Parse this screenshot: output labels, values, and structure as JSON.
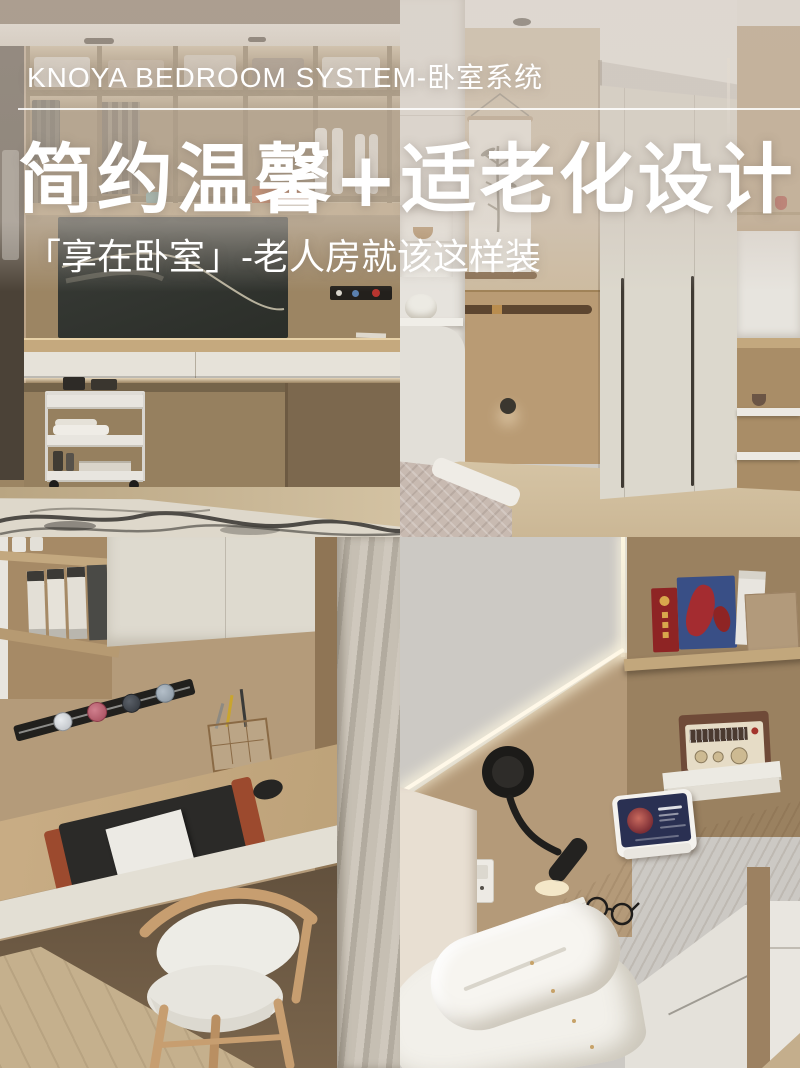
{
  "canvas": {
    "width": 800,
    "height": 1068
  },
  "overlay": {
    "brand_line": "KNOYA BEDROOM SYSTEM-卧室系统",
    "title": "简约温馨+适老化设计",
    "subtitle": "「享在卧室」-老人房就该这样装",
    "text_color": "#ffffff"
  },
  "palette": {
    "wash": "rgba(209,199,189,0.55)",
    "wood_mid": "#a98b68",
    "wood_light": "#c8b193",
    "wood_dark": "#7b6448",
    "wall_gray": "#cccac5",
    "cream": "#e3dfd6",
    "tv_screen": "#32352f",
    "rail_black": "#21201d",
    "accent_orange": "#c06336",
    "box_red": "#8e2424",
    "box_blue": "#394f86",
    "radio_brown": "#6f4a38",
    "screen_navy": "#2a3052",
    "curtain": "#c3bcb0",
    "floor_tan": "#c7b394",
    "led_glow": "#fff6e0"
  }
}
